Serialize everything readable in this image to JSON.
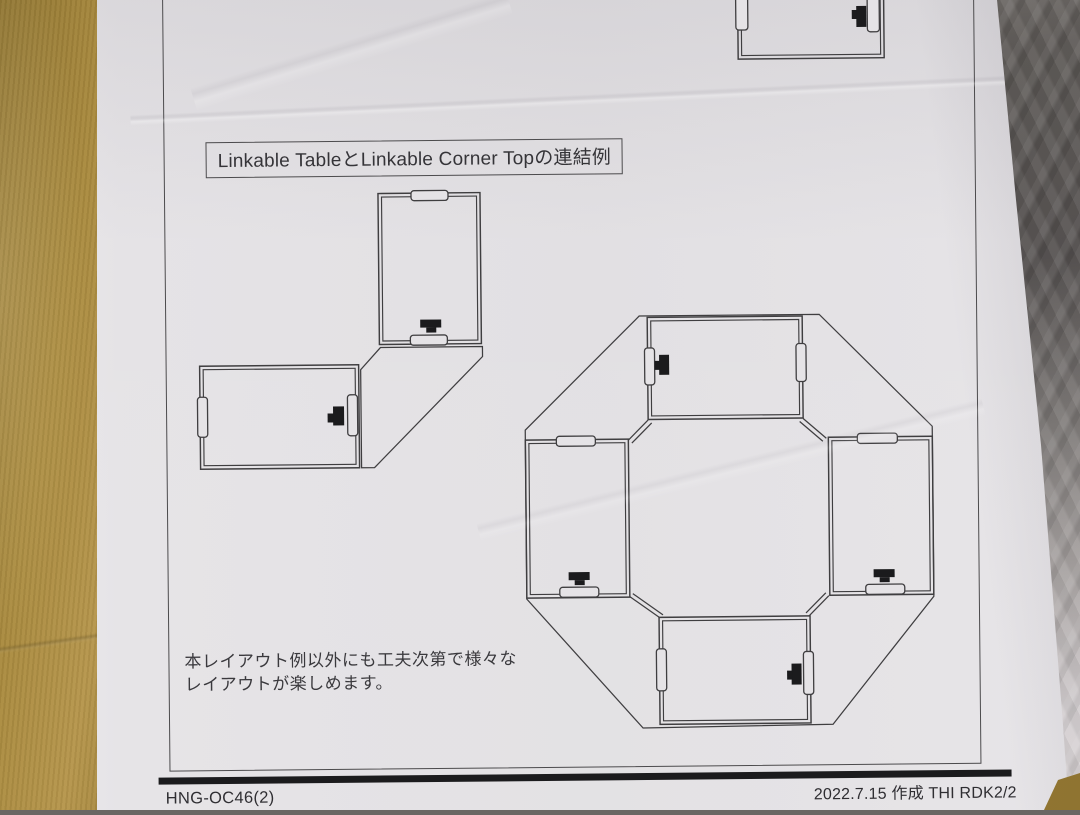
{
  "colors": {
    "paper": "#e5e3e6",
    "paper_bright": "#f3f1f4",
    "ink": "#3f3e40",
    "black_mark": "#1b1b1d",
    "cardboard": "#aa8b3f",
    "cardboard_dark": "#8f7431",
    "plastic_dark": "#5d5956",
    "plastic_mid": "#8b8784",
    "plastic_light": "#d3ced0"
  },
  "page": {
    "title": "Linkable TableとLinkable Corner Topの連結例",
    "note": {
      "line1": "本レイアウト例以外にも工夫次第で様々な",
      "line2": "レイアウトが楽しめます。"
    },
    "footer": {
      "doc_code": "HNG-OC46(2)",
      "revision": "2022.7.15 作成 THI RDK2/2"
    },
    "diagrams": {
      "partial_table": "linkable-table-top-view-partial",
      "l_shape": "two-tables-with-one-corner-top-l-connection",
      "octagon": "four-tables-with-four-corner-tops-octagon-connection"
    }
  }
}
